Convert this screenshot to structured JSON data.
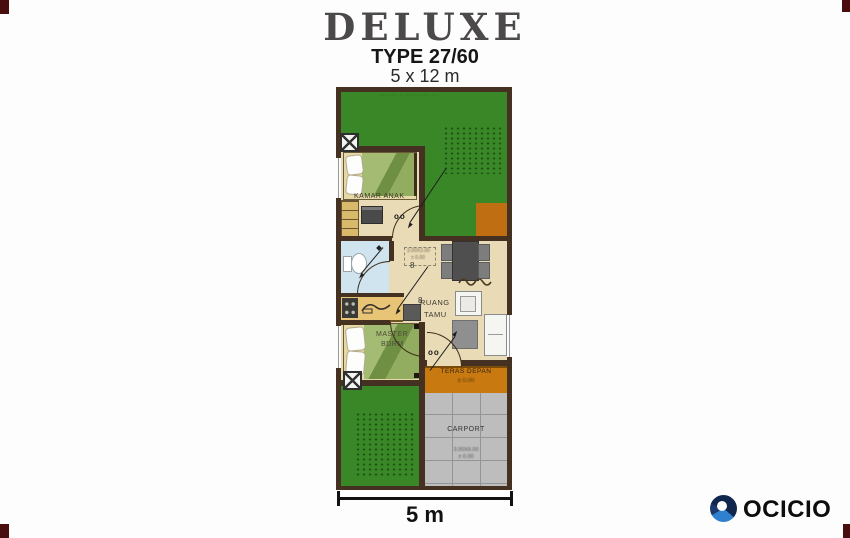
{
  "title": {
    "main": "DELUXE",
    "type_label": "TYPE 27/60",
    "size_label": "5 x 12 m"
  },
  "plan": {
    "labels": {
      "kamar_anak": "KAMAR ANAK",
      "ruang_tamu_1": "RUANG",
      "ruang_tamu_2": "TAMU",
      "master_1": "MASTER",
      "master_2": "BDRM",
      "teras": "TERAS DEPAN",
      "teras_elev": "± 0.00",
      "carport": "CARPORT",
      "carport_dim": "3.00X6.00",
      "carport_elev": "± 0.00",
      "living_dim_1": "3.00X3.00",
      "living_dim_2": "± 0.00",
      "door_swing_mark": "oo",
      "ceiling_point_mark": "8",
      "garden_note": "·· ··· · ···· ··· ··"
    }
  },
  "scale_bar": {
    "label": "5 m"
  },
  "brand": {
    "name": "OCICIO"
  },
  "colors": {
    "garden_green": "#3a8727",
    "wall_brown": "#443121",
    "floor_cream": "#e9dbb6",
    "bath_blue": "#cfe4ee",
    "kitchen_tan": "#e8c476",
    "teras_orange": "#c8790f",
    "carport_gray": "#bdbdbd",
    "bed_green": "#a3bb72",
    "logo_navy": "#122c57",
    "logo_blue": "#2f80cf"
  }
}
